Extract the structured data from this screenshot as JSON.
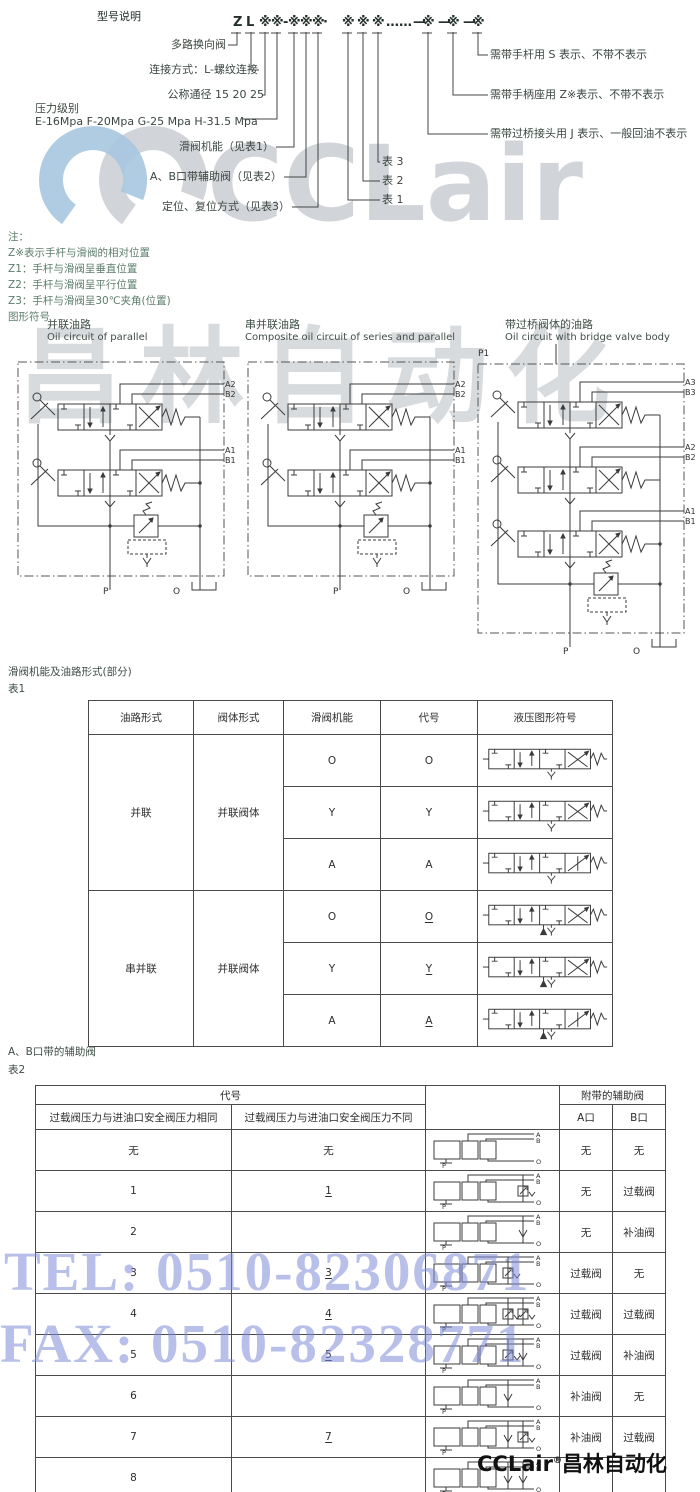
{
  "page_title": "型号说明",
  "model_code": {
    "tokens": [
      "Z",
      "L",
      "※",
      "※",
      "-",
      "※",
      "※",
      "※",
      "·",
      "※",
      "※",
      "※",
      "……",
      "—",
      "※",
      "—",
      "※",
      "—",
      "※"
    ],
    "left_labels": [
      "多路换向阀",
      "连接方式：L-螺纹连接",
      "公称通径 15 20 25",
      "压力级别",
      "E-16Mpa F-20Mpa G-25 Mpa H-31.5 Mpa",
      "滑阀机能（见表1）",
      "A、B口带辅助阀（见表2）",
      "定位、复位方式（见表3）"
    ],
    "table_refs": [
      "表 1",
      "表 2",
      "表 3"
    ],
    "right_labels": [
      "需带手杆用 S 表示、不带不表示",
      "需带手柄座用 Z※表示、不带不表示",
      "需带过桥接头用 J 表示、一般回油不表示"
    ]
  },
  "notes": {
    "label": "注：",
    "lines": [
      "Z※表示手杆与滑阀的相对位置",
      "Z1：手杆与滑阀呈垂直位置",
      "Z2：手杆与滑阀呈平行位置",
      "Z3：手杆与滑阀呈30℃夹角(位置)"
    ],
    "graphic_label": "图形符号"
  },
  "circuits": [
    {
      "title_cn": "并联油路",
      "title_en": "Oil circuit of parallel",
      "port_labels": [
        "A2",
        "B2",
        "A1",
        "B1"
      ],
      "bottom_labels": [
        "P",
        "O"
      ]
    },
    {
      "title_cn": "串并联油路",
      "title_en": "Composite oil circuit of series and parallel",
      "port_labels": [
        "A2",
        "B2",
        "A1",
        "B1"
      ],
      "bottom_labels": [
        "P",
        "O"
      ]
    },
    {
      "title_cn": "带过桥阀体的油路",
      "title_en": "Oil circuit with bridge valve body",
      "top_label": "P1",
      "port_labels": [
        "A3",
        "B3",
        "A2",
        "B2",
        "A1",
        "B1"
      ],
      "bottom_labels": [
        "P",
        "O"
      ]
    }
  ],
  "table1": {
    "section_title": "滑阀机能及油路形式(部分)",
    "label": "表1",
    "headers": [
      "油路形式",
      "阀体形式",
      "滑阀机能",
      "代号",
      "液压图形符号"
    ],
    "groups": [
      {
        "circuit": "并联",
        "body": "并联阀体",
        "rows": [
          {
            "fn": "O",
            "code": "O",
            "underline": false
          },
          {
            "fn": "Y",
            "code": "Y",
            "underline": false
          },
          {
            "fn": "A",
            "code": "A",
            "underline": false
          }
        ]
      },
      {
        "circuit": "串并联",
        "body": "并联阀体",
        "rows": [
          {
            "fn": "O",
            "code": "O",
            "underline": true
          },
          {
            "fn": "Y",
            "code": "Y",
            "underline": true
          },
          {
            "fn": "A",
            "code": "A",
            "underline": true
          }
        ]
      }
    ]
  },
  "table2": {
    "section_title": "A、B口带的辅助阀",
    "label": "表2",
    "header": {
      "code_group": "代号",
      "col_same": "过载阀压力与进油口安全阀压力相同",
      "col_diff": "过载阀压力与进油口安全阀压力不同",
      "aux_group": "附带的辅助阀",
      "col_a": "A口",
      "col_b": "B口"
    },
    "sym_ports": [
      "A",
      "B",
      "P",
      "O"
    ],
    "rows": [
      {
        "same": "无",
        "diff": "",
        "diff_u": false,
        "a": "无",
        "b": "无",
        "sym": {
          "a": "none",
          "b": "none"
        },
        "diff_text": "无"
      },
      {
        "same": "1",
        "diff": "1",
        "diff_u": true,
        "a": "无",
        "b": "过载阀",
        "sym": {
          "a": "none",
          "b": "relief"
        }
      },
      {
        "same": "2",
        "diff": "",
        "diff_u": false,
        "a": "无",
        "b": "补油阀",
        "sym": {
          "a": "none",
          "b": "check"
        }
      },
      {
        "same": "3",
        "diff": "3",
        "diff_u": true,
        "a": "过载阀",
        "b": "无",
        "sym": {
          "a": "relief",
          "b": "none"
        }
      },
      {
        "same": "4",
        "diff": "4",
        "diff_u": true,
        "a": "过载阀",
        "b": "过载阀",
        "sym": {
          "a": "relief",
          "b": "relief"
        }
      },
      {
        "same": "5",
        "diff": "5",
        "diff_u": true,
        "a": "过载阀",
        "b": "补油阀",
        "sym": {
          "a": "relief",
          "b": "check"
        }
      },
      {
        "same": "6",
        "diff": "",
        "diff_u": false,
        "a": "补油阀",
        "b": "无",
        "sym": {
          "a": "check",
          "b": "none"
        }
      },
      {
        "same": "7",
        "diff": "7",
        "diff_u": true,
        "a": "补油阀",
        "b": "过载阀",
        "sym": {
          "a": "check",
          "b": "relief"
        }
      },
      {
        "same": "8",
        "diff": "",
        "diff_u": false,
        "a": "",
        "b": "",
        "sym": {
          "a": "check",
          "b": "check"
        }
      }
    ]
  },
  "watermarks": {
    "logo_text": "CCLair",
    "mid_text": "昌林自动化",
    "tel": "TEL: 0510-82306871",
    "fax": "FAX: 0510-82328771",
    "accent_blue": "#a7c6e0",
    "logo_grey": "#c6cad0",
    "telfax_color": "rgba(126,140,216,0.55)"
  },
  "footer": {
    "brand": "CCLair",
    "reg": "®",
    "company": "昌林自动化"
  }
}
